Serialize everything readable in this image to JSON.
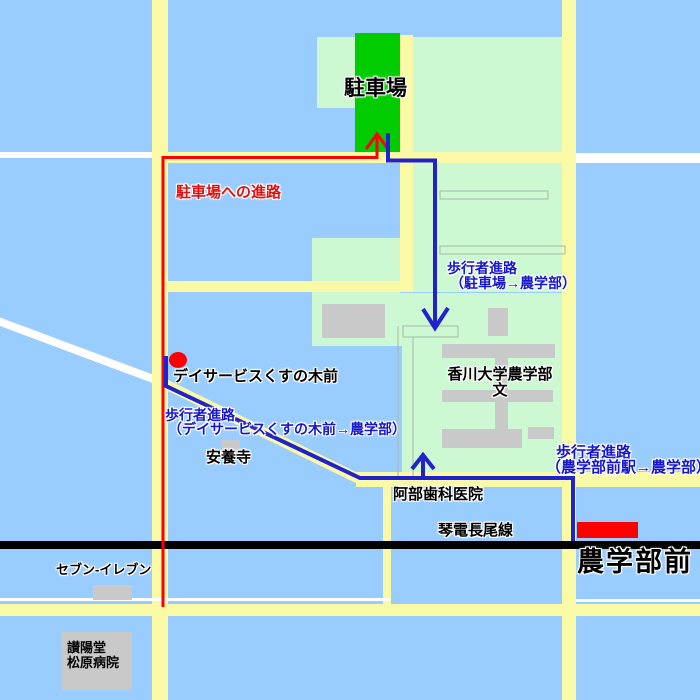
{
  "colors": {
    "water": "#99ccff",
    "campus_green": "#ccf8d2",
    "parking_green": "#00cc00",
    "road_yellow": "#f9f9a6",
    "road_white": "#ffffff",
    "building_gray": "#c9c9c9",
    "railway_black": "#000000",
    "route_red": "#ff0000",
    "route_blue": "#2222cc",
    "station_red": "#ff0000",
    "label_blue": "#1616cc",
    "label_red": "#e01010",
    "label_black": "#000000",
    "outline_gray": "#a8b8a8"
  },
  "labels": {
    "parking": "駐車場",
    "parking_route": "駐車場への進路",
    "ped_route_parking_line1": "歩行者進路",
    "ped_route_parking_line2": "（駐車場→農学部）",
    "day_service_stop": "デイサービスくすの木前",
    "ped_route_dayservice_line1": "歩行者進路",
    "ped_route_dayservice_line2": "（デイサービスくすの木前→農学部）",
    "anyoji_temple": "安養寺",
    "university_line1": "香川大学農学部",
    "university_line2": "文",
    "ped_route_station_line1": "歩行者進路",
    "ped_route_station_line2": "（農学部前駅→農学部）",
    "abe_dental": "阿部歯科医院",
    "railway_line": "琴電長尾線",
    "station": "農学部前",
    "seven_eleven": "セブン-イレブン",
    "hospital_line1": "讃陽堂",
    "hospital_line2": "松原病院"
  }
}
